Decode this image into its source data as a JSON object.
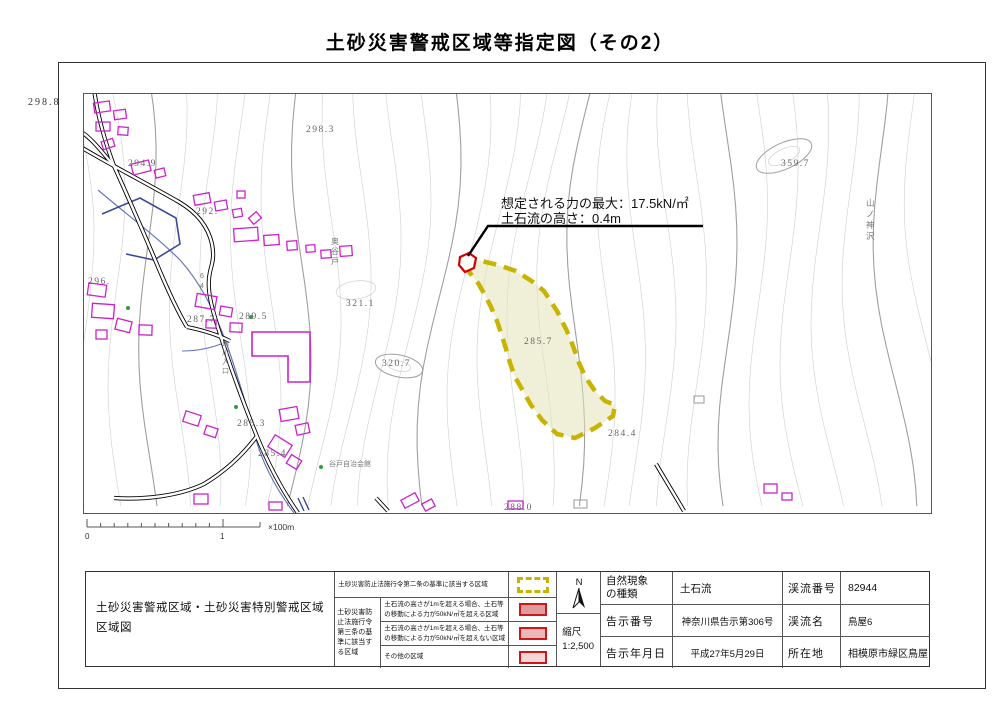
{
  "title": "土砂災害警戒区域等指定図（その2）",
  "map": {
    "corner_elevation": "298.8",
    "annotation": {
      "line1": "想定される力の最大：17.5kN/㎡",
      "line2": "土石流の高さ：0.4m"
    },
    "elevation_labels": [
      {
        "text": "298.3"
      },
      {
        "text": "359.7"
      },
      {
        "text": "294.9"
      },
      {
        "text": "292."
      },
      {
        "text": "296."
      },
      {
        "text": "287.7"
      },
      {
        "text": "289.5"
      },
      {
        "text": "321.1"
      },
      {
        "text": "320.7"
      },
      {
        "text": "285.7"
      },
      {
        "text": "285.3"
      },
      {
        "text": "285.4"
      },
      {
        "text": "284.4"
      },
      {
        "text": "288.0"
      }
    ],
    "place_labels": {
      "yamanokami": [
        "山",
        "ノ",
        "神",
        "沢"
      ],
      "okuyato": [
        "奥",
        "谷",
        "戸"
      ],
      "kushikawa": [
        "串",
        "川",
        "入",
        "口"
      ],
      "route": [
        "6",
        "4"
      ],
      "community_hall": "谷戸自治会館"
    }
  },
  "scalebar": {
    "zero": "0",
    "one": "1",
    "unit": "×100m"
  },
  "compass": {
    "label": "N"
  },
  "table": {
    "map_title_line1": "土砂災害警戒区域・土砂災害特別警戒区域",
    "map_title_line2": "区域図",
    "legend": {
      "article2_label": "土砂災害防止法施行令第二条の基準に該当する区域",
      "article3_group_label": "土砂災害防止法施行令第三条の基準に該当する区域",
      "rows": [
        {
          "text": "土石流の高さが1mを超える場合、土石等の移動による力が50kN/㎡を超える区域"
        },
        {
          "text": "土石流の高さが1mを超える場合、土石等の移動による力が50kN/㎡を超えない区域"
        },
        {
          "text": "その他の区域"
        }
      ]
    },
    "scale": {
      "label": "縮尺",
      "value": "1:2,500"
    },
    "info_left": [
      {
        "label": "自然現象の種類",
        "value": "土石流"
      },
      {
        "label": "告示番号",
        "value": "神奈川県告示第306号"
      },
      {
        "label": "告示年月日",
        "value": "平成27年5月29日"
      }
    ],
    "info_right": [
      {
        "label": "渓流番号",
        "value": "82944"
      },
      {
        "label": "渓流名",
        "value": "鳥屋6"
      },
      {
        "label": "所在地",
        "value": "相模原市緑区鳥屋"
      }
    ]
  },
  "colors": {
    "hazard_zone_border": "#c8b400",
    "hazard_zone_fill": "#e9e7c8",
    "special_zone_border": "#d40000",
    "legend_swatch_fills": [
      "#e09c9c",
      "#eab8b8",
      "#f3d6d6"
    ],
    "building_outline": "#cc22cc",
    "water_line": "#6677b8",
    "contour_line": "#cfcfcf"
  }
}
